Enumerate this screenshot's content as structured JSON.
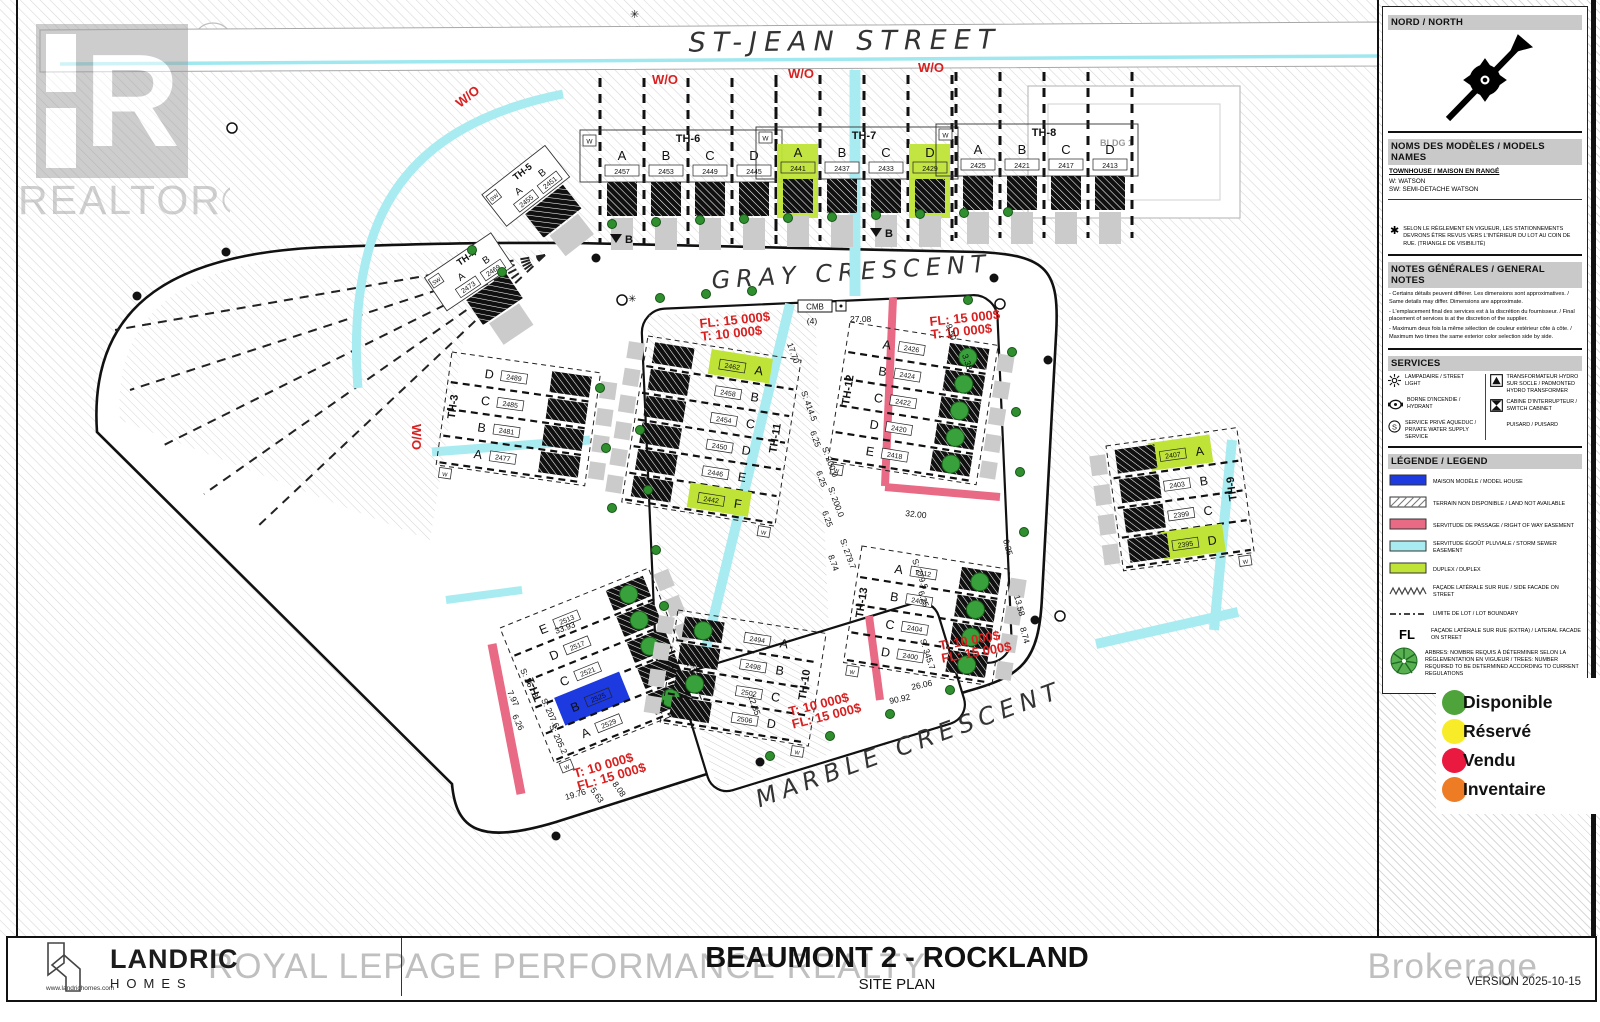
{
  "titleblock": {
    "title": "BEAUMONT 2 - ROCKLAND",
    "subtitle": "SITE PLAN",
    "version": "VERSION 2025-10-15",
    "logo_line1": "LANDRIC",
    "logo_line2": "HOMES",
    "logo_url": "www.landrichomes.com",
    "brokerage_watermark_left": "ROYAL LEPAGE PERFORMANCE REALTY",
    "brokerage_watermark_right": "Brokerage",
    "realtor_watermark": "REALTOR®"
  },
  "streets": {
    "st_jean": "ST-JEAN STREET",
    "gray": "GRAY CRESCENT",
    "marble": "MARBLE CRESCENT"
  },
  "panel": {
    "north_title": "NORD / NORTH",
    "models": {
      "title": "NOMS DES MODÈLES / MODELS NAMES",
      "category": "TOWNHOUSE / MAISON EN RANGÉ",
      "entries": [
        "W: WATSON",
        "SW: SEMI-DETACHE WATSON"
      ],
      "star_note": "SELON LE RÈGLEMENT EN VIGUEUR, LES STATIONNEMENTS DEVRONS ÊTRE REVUS VERS L'INTÉRIEUR DU LOT AU COIN DE RUE. (TRIANGLE DE VISIBILITÉ)"
    },
    "notes": {
      "title": "NOTES GÉNÉRALES / GENERAL NOTES",
      "lines": [
        "- Certains détails peuvent différer. Les dimensions sont approximatives. / Same details may differ. Dimensions are approximate.",
        "- L'emplacement final des services est à la discrétion du fournisseur. / Final placement of services is at the discretion of the supplier.",
        "- Maximum deux fois la même sélection de couleur extérieur côte à côte. / Maximum two times the same exterior color selection side by side."
      ]
    },
    "services": {
      "title": "SERVICES",
      "items": [
        {
          "icon": "street-light-icon",
          "label": "LAMPADAIRE / STREET LIGHT"
        },
        {
          "icon": "hydrant-icon",
          "label": "BORNE D'INCENDIE / HYDRANT"
        },
        {
          "icon": "water-supply-icon",
          "label": "SERVICE PRIVÉ AQUEDUC / PRIVATE WATER SUPPLY SERVICE"
        },
        {
          "icon": "transformer-icon",
          "label": "TRANSFORMATEUR HYDRO SUR SOCLE / PADMONTED HYDRO TRANSFORMER"
        },
        {
          "icon": "switch-cabinet-icon",
          "label": "CABINE D'INTERRUPTEUR / SWITCH CABINET"
        },
        {
          "icon": "puisard-icon",
          "label": "PUISARD / PUISARD"
        }
      ]
    },
    "legend": {
      "title": "LÉGENDE / LEGEND",
      "items": [
        {
          "swatch": "solid",
          "color": "#1d39e0",
          "label": "MAISON MODÈLE / MODEL HOUSE"
        },
        {
          "swatch": "hatch",
          "color": "#999999",
          "label": "TERRAIN NON DISPONIBLE / LAND NOT AVAILABLE"
        },
        {
          "swatch": "solid",
          "color": "#e96a85",
          "label": "SERVITUDE DE PASSAGE / RIGHT OF WAY EASEMENT"
        },
        {
          "swatch": "solid",
          "color": "#a8ecf1",
          "label": "SERVITUDE ÉGOÛT PLUVIALE / STORM SEWER EASEMENT"
        },
        {
          "swatch": "solid",
          "color": "#bfe437",
          "label": "DUPLEX / DUPLEX"
        },
        {
          "swatch": "zigzag",
          "color": "#444444",
          "label": "FAÇADE LATÉRALE SUR RUE / SIDE FACADE ON STREET"
        },
        {
          "swatch": "dash",
          "color": "#444444",
          "label": "LIMITE DE LOT / LOT BOUNDARY"
        },
        {
          "swatch": "fl",
          "text": "FL",
          "label": "FAÇADE LATÉRALE SUR RUE (EXTRA) / LATERAL FACADE ON STREET"
        },
        {
          "swatch": "tree",
          "color": "#4aa83e",
          "label": "ARBRES: NOMBRE REQUIS À DÉTERMINER SELON LA RÉGLEMENTATION EN VIGUEUR / TREES: NUMBER REQUIRED TO BE DETERMINED ACCORDING TO CURRENT REGULATIONS"
        }
      ]
    }
  },
  "status_legend": [
    {
      "color": "#4ea43a",
      "label": "Disponible"
    },
    {
      "color": "#f8ec28",
      "label": "Réservé"
    },
    {
      "color": "#ea1940",
      "label": "Vendu"
    },
    {
      "color": "#ee7c25",
      "label": "Inventaire"
    }
  ],
  "plan": {
    "building_label": "BLDG 1",
    "cmb_label": "CMB",
    "cmb_count": "(4)",
    "benchmark_label": "B",
    "blocks": [
      {
        "id": "TH-6",
        "kind": "row",
        "type": "W",
        "lots": [
          {
            "l": "A",
            "n": "2457"
          },
          {
            "l": "B",
            "n": "2453"
          },
          {
            "l": "C",
            "n": "2449"
          },
          {
            "l": "D",
            "n": "2445"
          }
        ]
      },
      {
        "id": "TH-7",
        "kind": "row",
        "type": "W",
        "lots": [
          {
            "l": "A",
            "n": "2441",
            "f": "duplex"
          },
          {
            "l": "B",
            "n": "2437"
          },
          {
            "l": "C",
            "n": "2433"
          },
          {
            "l": "D",
            "n": "2429",
            "f": "duplex"
          }
        ]
      },
      {
        "id": "TH-8",
        "kind": "row",
        "type": "W",
        "lots": [
          {
            "l": "A",
            "n": "2425"
          },
          {
            "l": "B",
            "n": "2421"
          },
          {
            "l": "C",
            "n": "2417"
          },
          {
            "l": "D",
            "n": "2413"
          }
        ]
      },
      {
        "id": "TH-5",
        "kind": "sw",
        "type": "SW",
        "lots": [
          {
            "l": "A",
            "n": "2455"
          },
          {
            "l": "B",
            "n": "2451"
          }
        ]
      },
      {
        "id": "TH-4",
        "kind": "sw",
        "type": "SW",
        "lots": [
          {
            "l": "A",
            "n": "2473"
          },
          {
            "l": "B",
            "n": "2469"
          }
        ]
      },
      {
        "id": "TH-3",
        "kind": "col",
        "type": "W",
        "lots": [
          {
            "l": "D",
            "n": "2489"
          },
          {
            "l": "C",
            "n": "2485"
          },
          {
            "l": "B",
            "n": "2481"
          },
          {
            "l": "A",
            "n": "2477"
          }
        ]
      },
      {
        "id": "TH-1",
        "kind": "col",
        "type": "W",
        "lots": [
          {
            "l": "E",
            "n": "2513",
            "s": "available"
          },
          {
            "l": "D",
            "n": "2517",
            "s": "available"
          },
          {
            "l": "C",
            "n": "2521",
            "s": "available"
          },
          {
            "l": "B",
            "n": "2525",
            "f": "model"
          },
          {
            "l": "A",
            "n": "2529",
            "s": "available"
          }
        ]
      },
      {
        "id": "TH-11",
        "kind": "col",
        "type": "W",
        "lots": [
          {
            "l": "A",
            "n": "2462",
            "f": "duplex"
          },
          {
            "l": "B",
            "n": "2458"
          },
          {
            "l": "C",
            "n": "2454"
          },
          {
            "l": "D",
            "n": "2450"
          },
          {
            "l": "E",
            "n": "2446"
          },
          {
            "l": "F",
            "n": "2442",
            "f": "duplex"
          }
        ]
      },
      {
        "id": "TH-10",
        "kind": "col",
        "type": "W",
        "lots": [
          {
            "l": "A",
            "n": "2494",
            "s": "available"
          },
          {
            "l": "B",
            "n": "2498"
          },
          {
            "l": "C",
            "n": "2502",
            "s": "available"
          },
          {
            "l": "D",
            "n": "2506"
          }
        ]
      },
      {
        "id": "TH-12",
        "kind": "col",
        "type": "W",
        "lots": [
          {
            "l": "A",
            "n": "2426",
            "s": "available"
          },
          {
            "l": "B",
            "n": "2424",
            "s": "available"
          },
          {
            "l": "C",
            "n": "2422",
            "s": "available"
          },
          {
            "l": "D",
            "n": "2420",
            "s": "available"
          },
          {
            "l": "E",
            "n": "2418",
            "s": "available"
          }
        ]
      },
      {
        "id": "TH-13",
        "kind": "col",
        "type": "W",
        "lots": [
          {
            "l": "A",
            "n": "2412",
            "s": "available"
          },
          {
            "l": "B",
            "n": "2408",
            "s": "available"
          },
          {
            "l": "C",
            "n": "2404",
            "s": "available"
          },
          {
            "l": "D",
            "n": "2400",
            "s": "available"
          }
        ]
      },
      {
        "id": "TH-9",
        "kind": "col",
        "type": "W",
        "lots": [
          {
            "l": "A",
            "n": "2407",
            "f": "duplex"
          },
          {
            "l": "B",
            "n": "2403"
          },
          {
            "l": "C",
            "n": "2399"
          },
          {
            "l": "D",
            "n": "2395",
            "f": "duplex"
          }
        ]
      }
    ],
    "red_notes": [
      {
        "text": [
          "W/O"
        ]
      },
      {
        "text": [
          "W/O"
        ]
      },
      {
        "text": [
          "W/O"
        ]
      },
      {
        "text": [
          "W/O"
        ]
      },
      {
        "text": [
          "W/O"
        ]
      },
      {
        "text": [
          "FL: 15 000$",
          "T: 10 000$"
        ]
      },
      {
        "text": [
          "FL: 15 000$",
          "T: 10 000$"
        ]
      },
      {
        "text": [
          "T: 10 000$",
          "FL: 15 000$"
        ]
      },
      {
        "text": [
          "T: 10 000$",
          "FL: 15 000$"
        ]
      },
      {
        "text": [
          "T: 10 000$",
          "FL: 15 000$"
        ]
      }
    ],
    "dimensions": [
      "27.08",
      "9.50",
      "3.38",
      "17.70",
      "S: 414.5",
      "6.25",
      "S: 200.0",
      "6.25",
      "S: 200.0",
      "6.25",
      "8.74",
      "S: 279.7",
      "32.00",
      "S: 279.5",
      "6.25",
      "S: 345.7",
      "12.35",
      "90.92",
      "26.06",
      "33.93",
      "S: 267.8",
      "7.97",
      "6.26",
      "S: 207.6",
      "S: 205.2",
      "19.76",
      "5.63",
      "8.08",
      "13.58",
      "8.74",
      "7.95",
      "6.25"
    ]
  },
  "colors": {
    "duplex": "#bfe437",
    "model": "#1d39e0",
    "storm": "#a8ecf1",
    "row_easement": "#e96a85",
    "available": "#39a13b"
  }
}
